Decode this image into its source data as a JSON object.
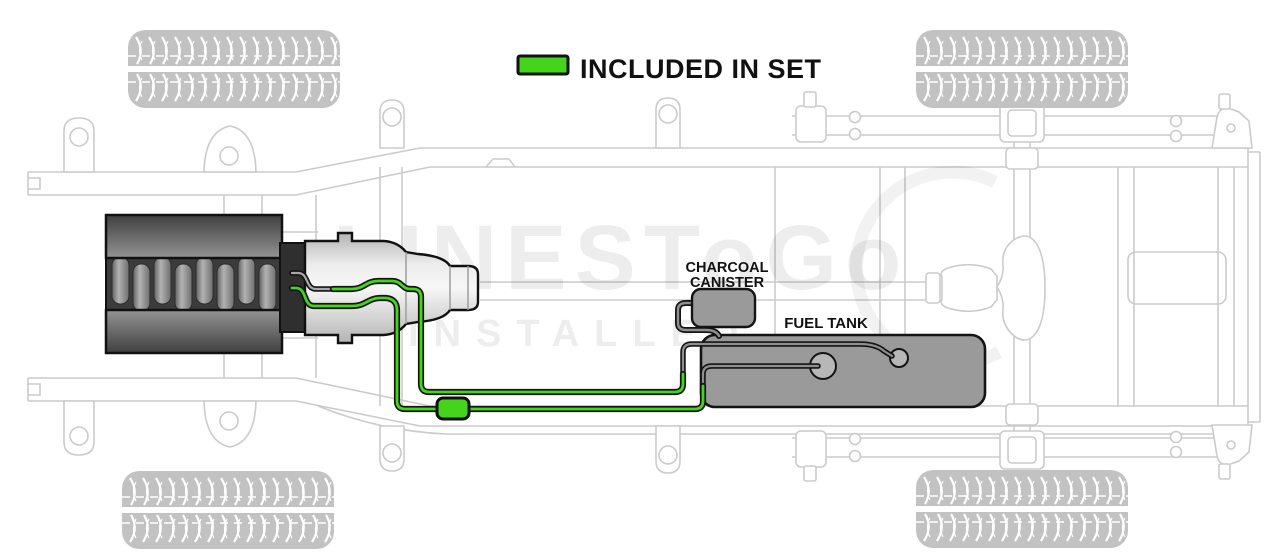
{
  "legend": {
    "label": "INCLUDED IN SET"
  },
  "labels": {
    "charcoal_canister_line1": "CHARCOAL",
    "charcoal_canister_line2": "CANISTER",
    "fuel_tank": "FUEL TANK"
  },
  "watermark": {
    "brand": "LINESToGo",
    "tagline": "INSTALLED"
  },
  "colors": {
    "included_green": "#44d41c",
    "component_gray": "#9a9a9a",
    "component_outline": "#141414",
    "frame_line": "#cbcbcb"
  },
  "diagram": {
    "view": "truck-chassis-underbody-fuel-line-routing",
    "included_in_set": [
      "fuel feed line",
      "fuel return line",
      "inline fuel filter"
    ],
    "reference_parts": [
      "engine",
      "transmission",
      "driveshaft",
      "charcoal canister",
      "fuel tank",
      "fuel pump module",
      "frame rails",
      "leaf springs",
      "rear axle",
      "tires"
    ]
  }
}
